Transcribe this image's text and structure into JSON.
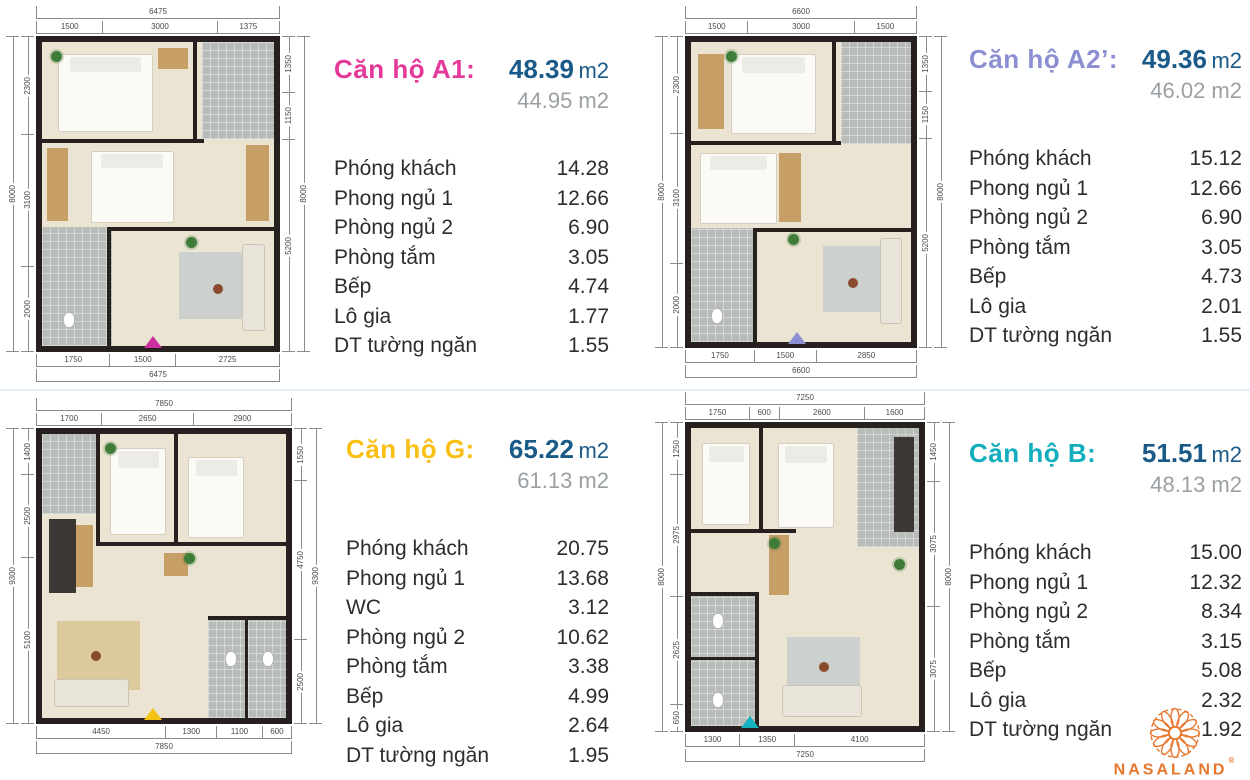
{
  "colors": {
    "area_value_blue": "#1a5a88",
    "area_secondary_gray": "#9aa0a4",
    "dimension_text": "#4a4a4a",
    "wall_dark": "#26211f"
  },
  "logo": {
    "wordmark": "NASALAND",
    "registered": "®",
    "color": "#e8772e"
  },
  "units": [
    {
      "id": "A1",
      "title": "Căn hộ A1:",
      "title_color": "#e5399a",
      "accent": "#cc2f9f",
      "area_value": "48.39",
      "area_unit": "m2",
      "area_secondary": "44.95 m2",
      "rooms": [
        {
          "label": "Phóng khách",
          "value": "14.28"
        },
        {
          "label": "Phong ngủ 1",
          "value": "12.66"
        },
        {
          "label": "Phòng ngủ 2",
          "value": "6.90"
        },
        {
          "label": "Phòng tắm",
          "value": "3.05"
        },
        {
          "label": "Bếp",
          "value": "4.74"
        },
        {
          "label": "Lô gia",
          "value": "1.77"
        },
        {
          "label": "DT tường ngăn",
          "value": "1.55"
        }
      ],
      "dims": {
        "top_total": "6475",
        "top": [
          "1500",
          "3000",
          "1375"
        ],
        "bottom": [
          "1750",
          "1500",
          "2725"
        ],
        "bottom_total": "6475",
        "left_total": "8000",
        "left": [
          "2300",
          "3100",
          "2000"
        ],
        "right": [
          "1350",
          "1150",
          "5200"
        ],
        "right_total": "8000"
      }
    },
    {
      "id": "A2'",
      "title": "Căn hộ A2’:",
      "title_color": "#8b8fd2",
      "accent": "#8b8fd2",
      "area_value": "49.36",
      "area_unit": "m2",
      "area_secondary": "46.02 m2",
      "rooms": [
        {
          "label": "Phóng khách",
          "value": "15.12"
        },
        {
          "label": "Phong ngủ 1",
          "value": "12.66"
        },
        {
          "label": "Phòng ngủ 2",
          "value": "6.90"
        },
        {
          "label": "Phòng tắm",
          "value": "3.05"
        },
        {
          "label": "Bếp",
          "value": "4.73"
        },
        {
          "label": "Lô gia",
          "value": "2.01"
        },
        {
          "label": "DT tường ngăn",
          "value": "1.55"
        }
      ],
      "dims": {
        "top_total": "6600",
        "top": [
          "1500",
          "3000",
          "1500"
        ],
        "bottom": [
          "1750",
          "1500",
          "2850"
        ],
        "bottom_total": "6600",
        "left_total": "8000",
        "left": [
          "2300",
          "3100",
          "2000"
        ],
        "right": [
          "1350",
          "1150",
          "5200"
        ],
        "right_total": "8000"
      }
    },
    {
      "id": "G",
      "title": "Căn hộ G:",
      "title_color": "#f9c013",
      "accent": "#f3c212",
      "area_value": "65.22",
      "area_unit": "m2",
      "area_secondary": "61.13 m2",
      "rooms": [
        {
          "label": "Phóng khách",
          "value": "20.75"
        },
        {
          "label": "Phong ngủ 1",
          "value": "13.68"
        },
        {
          "label": "WC",
          "value": "3.12"
        },
        {
          "label": "Phòng ngủ 2",
          "value": "10.62"
        },
        {
          "label": "Phòng tắm",
          "value": "3.38"
        },
        {
          "label": "Bếp",
          "value": "4.99"
        },
        {
          "label": "Lô gia",
          "value": "2.64"
        },
        {
          "label": "DT tường ngăn",
          "value": "1.95"
        }
      ],
      "dims": {
        "top_total": "7850",
        "top": [
          "1700",
          "2650",
          "2900"
        ],
        "bottom": [
          "4450",
          "1300",
          "1100",
          "600"
        ],
        "bottom_total": "7850",
        "left_total": "9300",
        "left": [
          "1400",
          "2500",
          "5100"
        ],
        "right": [
          "1550",
          "4750",
          "2500"
        ],
        "right_total": "9300"
      }
    },
    {
      "id": "B",
      "title": "Căn hộ B:",
      "title_color": "#12adbc",
      "accent": "#14b0bd",
      "area_value": "51.51",
      "area_unit": "m2",
      "area_secondary": "48.13 m2",
      "rooms": [
        {
          "label": "Phóng khách",
          "value": "15.00"
        },
        {
          "label": "Phong ngủ 1",
          "value": "12.32"
        },
        {
          "label": "Phòng ngủ 2",
          "value": "8.34"
        },
        {
          "label": "Phòng tắm",
          "value": "3.15"
        },
        {
          "label": "Bếp",
          "value": "5.08"
        },
        {
          "label": "Lô gia",
          "value": "2.32"
        },
        {
          "label": "DT tường ngăn",
          "value": "1.92"
        }
      ],
      "dims": {
        "top_total": "7250",
        "top": [
          "1750",
          "600",
          "2600",
          "1600"
        ],
        "bottom": [
          "1300",
          "1350",
          "4100"
        ],
        "bottom_total": "7250",
        "left_total": "8000",
        "left": [
          "1250",
          "2975",
          "2625",
          "650"
        ],
        "right": [
          "1450",
          "3075",
          "3075"
        ],
        "right_total": "8000"
      }
    }
  ]
}
